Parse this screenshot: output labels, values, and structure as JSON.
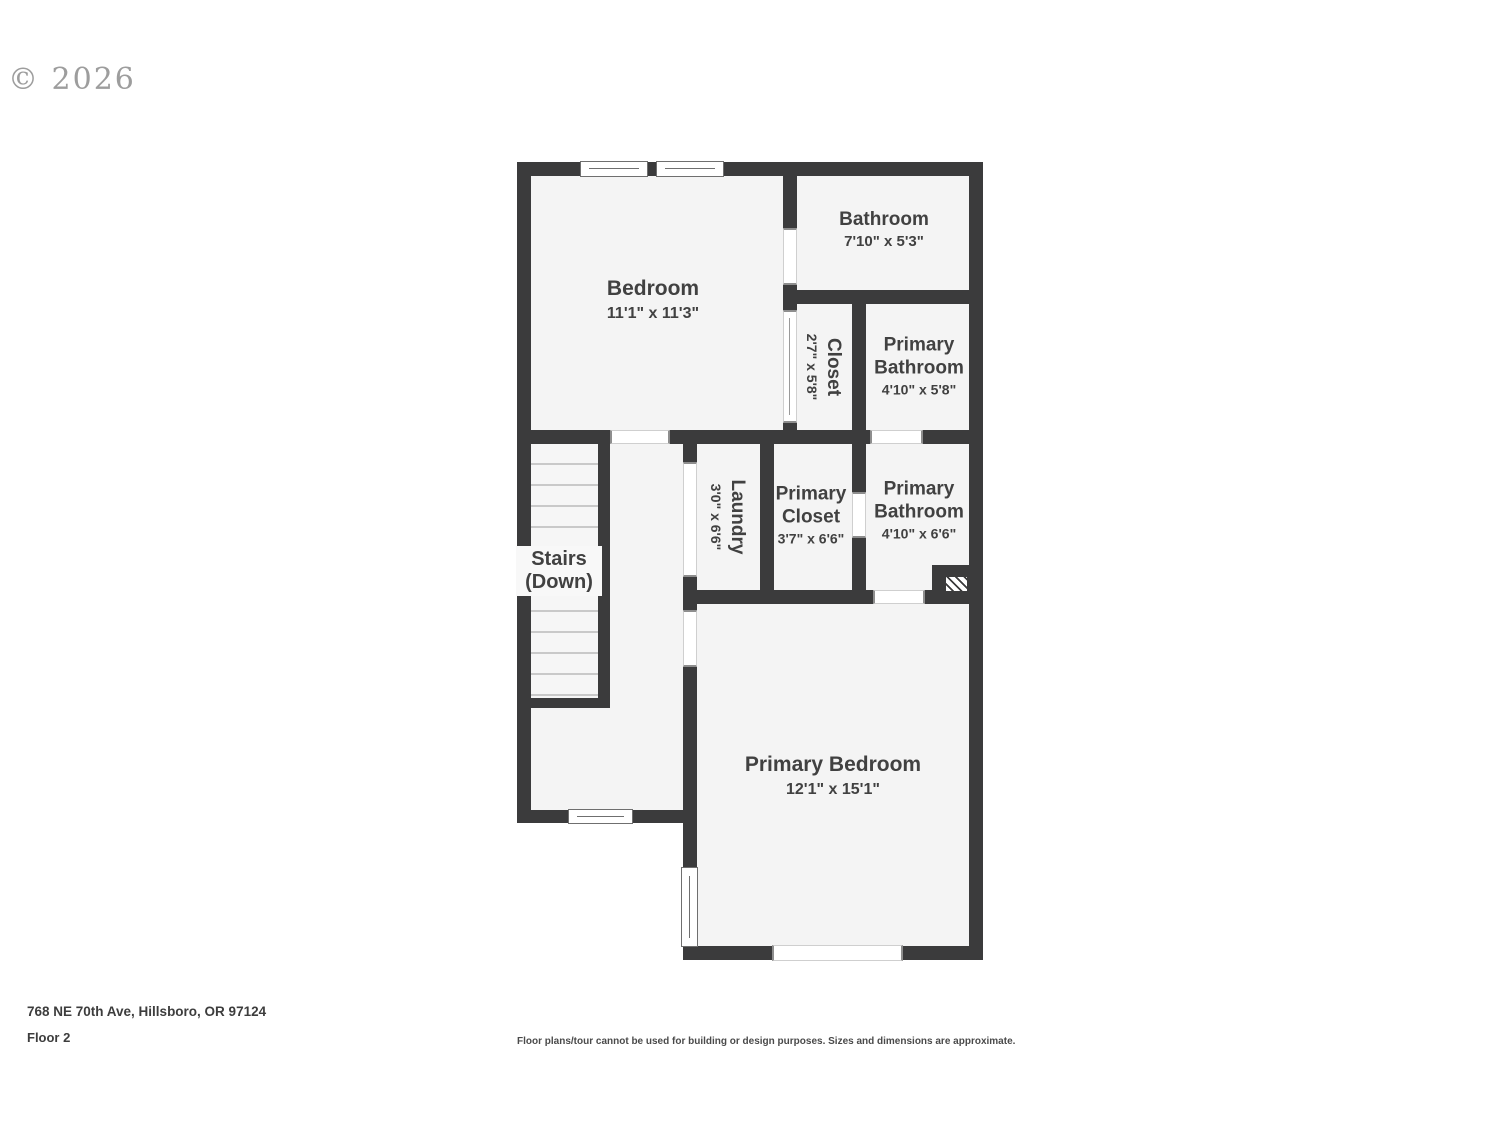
{
  "watermark": "© 2026",
  "plan": {
    "rooms": [
      {
        "name": "Bedroom",
        "dims": "11'1\" x 11'3\""
      },
      {
        "name": "Bathroom",
        "dims": "7'10\" x 5'3\""
      },
      {
        "name": "Closet",
        "dims": "2'7\" x 5'8\""
      },
      {
        "name": "Primary Bathroom",
        "dims": "4'10\" x 5'8\""
      },
      {
        "name": "Laundry",
        "dims": "3'0\" x 6'6\""
      },
      {
        "name": "Primary Closet",
        "dims": "3'7\" x 6'6\""
      },
      {
        "name": "Primary Bathroom",
        "dims": "4'10\" x 6'6\""
      },
      {
        "name": "Stairs (Down)",
        "dims": ""
      },
      {
        "name": "Primary Bedroom",
        "dims": "12'1\" x 15'1\""
      }
    ]
  },
  "footer": {
    "address": "768 NE 70th Ave, Hillsboro, OR 97124",
    "floor_label": "Floor 2",
    "disclaimer": "Floor plans/tour cannot be used for building or design purposes. Sizes and dimensions are approximate."
  },
  "colors": {
    "wall": "#3b3b3c",
    "floor_fill": "#f4f4f4",
    "label_text": "#414141"
  }
}
